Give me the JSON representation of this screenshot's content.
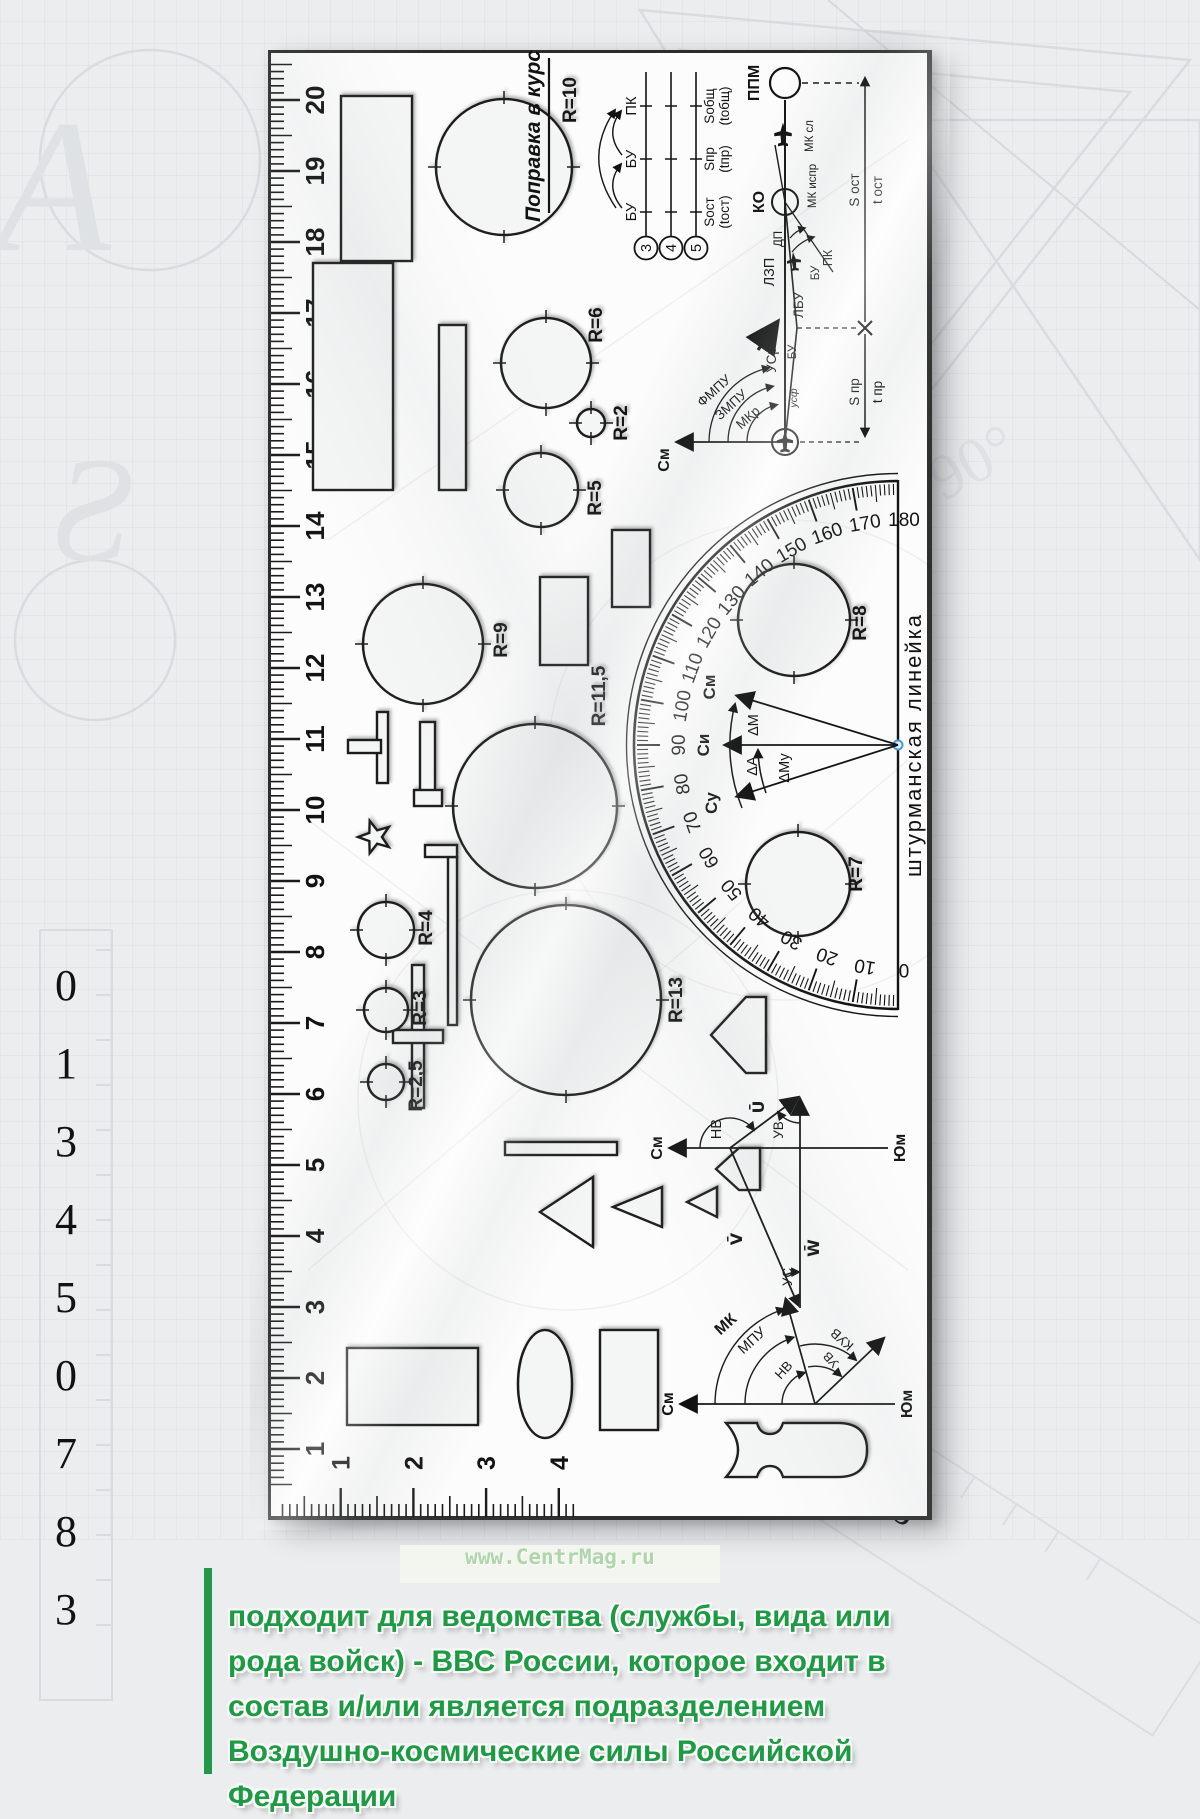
{
  "watermark_url": "www.CentrMag.ru",
  "colors": {
    "accent_green": "#1e9a45",
    "url_green": "#afd6ab",
    "pivot_blue": "#4a9bd4",
    "ink": "#141414",
    "background": "#ecedee"
  },
  "caption": {
    "lines": [
      "подходит для ведомства (службы, вида или",
      "рода войск) - ВВС России, которое входит в",
      "состав и/или является подразделением",
      "Воздушно-космические силы Российской",
      "Федерации"
    ]
  },
  "ruler": {
    "name": "штурманская линейка",
    "cm_scale": {
      "numbers": [
        1,
        2,
        3,
        4,
        5,
        6,
        7,
        8,
        9,
        10,
        11,
        12,
        13,
        14,
        15,
        16,
        17,
        18,
        19,
        20
      ]
    },
    "end_scale": {
      "numbers": [
        1,
        2,
        3,
        4
      ]
    },
    "protractor": {
      "degrees": [
        0,
        10,
        20,
        30,
        40,
        50,
        60,
        70,
        80,
        90,
        100,
        110,
        120,
        130,
        140,
        150,
        160,
        170,
        180
      ],
      "arrows": [
        "Су",
        "Си",
        "См"
      ],
      "deltas": [
        "ΔА",
        "ΔМ",
        "ΔМу"
      ]
    },
    "circles": [
      {
        "label": "R=10",
        "r_mm": 10,
        "x": 1353,
        "y": 236,
        "r": 68,
        "lx": 67,
        "ly": 72
      },
      {
        "label": "R=6",
        "r_mm": 6,
        "x": 1157,
        "y": 278,
        "r": 45,
        "lx": 38,
        "ly": 56
      },
      {
        "label": "R=2",
        "r_mm": 2,
        "x": 1097,
        "y": 323,
        "r": 14,
        "lx": 0,
        "ly": 36
      },
      {
        "label": "R=5",
        "r_mm": 5,
        "x": 1030,
        "y": 273,
        "r": 37,
        "lx": -8,
        "ly": 60
      },
      {
        "label": "R=9",
        "r_mm": 9,
        "x": 876,
        "y": 155,
        "r": 60,
        "lx": 4,
        "ly": 84
      },
      {
        "label": "R=11,5",
        "r_mm": 11.5,
        "x": 714,
        "y": 267,
        "r": 82,
        "lx": 110,
        "ly": 70
      },
      {
        "label": "R=8",
        "r_mm": 8,
        "x": 900,
        "y": 526,
        "r": 56,
        "lx": -3,
        "ly": 72
      },
      {
        "label": "R=7",
        "r_mm": 7,
        "x": 636,
        "y": 530,
        "r": 52,
        "lx": 10,
        "ly": 64
      },
      {
        "label": "R=13",
        "r_mm": 13,
        "x": 520,
        "y": 298,
        "r": 95,
        "lx": 0,
        "ly": 116
      },
      {
        "label": "R=4",
        "r_mm": 4,
        "x": 590,
        "y": 118,
        "r": 28,
        "lx": 2,
        "ly": 46
      },
      {
        "label": "R=3",
        "r_mm": 3,
        "x": 510,
        "y": 118,
        "r": 22,
        "lx": 2,
        "ly": 40
      },
      {
        "label": "R=2,5",
        "r_mm": 2.5,
        "x": 438,
        "y": 118,
        "r": 18,
        "lx": -4,
        "ly": 36
      }
    ],
    "correction_table": {
      "title": "Поправка в курс",
      "row_numbers": [
        "3",
        "4",
        "5"
      ],
      "columns": [
        "БУ",
        "БУ",
        "ПК"
      ],
      "sums": [
        [
          "Sост",
          "(tост)"
        ],
        [
          "Sпр",
          "(tпр)"
        ],
        [
          "Sобщ",
          "(tобщ)"
        ]
      ]
    },
    "course_diagram": {
      "ppm": "ППМ",
      "ko": "КО",
      "mk_sl": "МК сл",
      "mk_ispr": "МК испр",
      "lzp": "ЛЗП",
      "lbu": "ЛБУ",
      "usr": "УСр",
      "bu": "БУ",
      "bu2": "БУ",
      "dp": "ДП",
      "pk": "ПК",
      "usf": "усф",
      "fmpu": "ФМПУ",
      "zmpu": "ЗМПУ",
      "mkr": "МКр",
      "sm": "См",
      "s_ost": "S ост",
      "t_ost": "t ост",
      "s_pr": "S пр",
      "t_pr": "t пр"
    },
    "wind_triangle": {
      "sm": "См",
      "yum": "Юм",
      "nv": "НВ",
      "uv": "УВ",
      "u": "Ū",
      "v": "V̄",
      "w": "W̄",
      "us": "УС"
    },
    "wind_rose": {
      "sm": "См",
      "yum": "Юм",
      "mk": "МК",
      "mpu": "МПУ",
      "nv": "НВ",
      "kuv": "КУВ",
      "uv": "УВ"
    }
  }
}
